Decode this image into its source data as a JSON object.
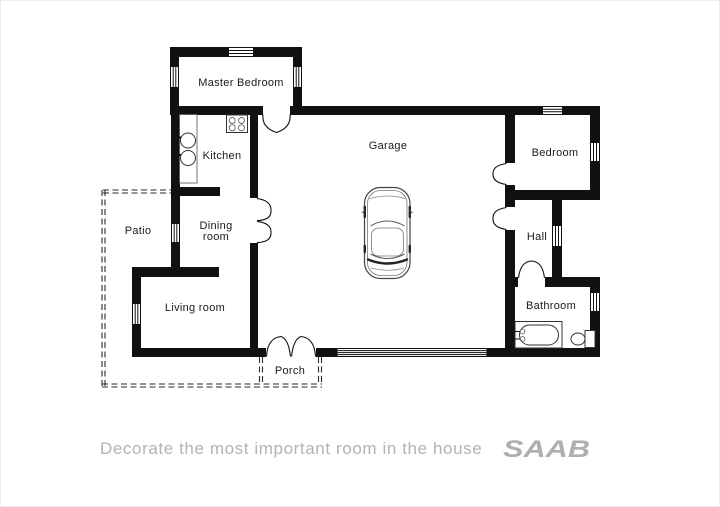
{
  "brand": {
    "tagline": "Decorate the most important room in the house",
    "logo": "SAAB"
  },
  "rooms": {
    "master_bedroom": {
      "label": "Master Bedroom"
    },
    "kitchen": {
      "label": "Kitchen"
    },
    "dining_room": {
      "line1": "Dining",
      "line2": "room"
    },
    "patio": {
      "label": "Patio"
    },
    "living_room": {
      "label": "Living room"
    },
    "porch": {
      "label": "Porch"
    },
    "garage": {
      "label": "Garage"
    },
    "bedroom": {
      "label": "Bedroom"
    },
    "hall": {
      "label": "Hall"
    },
    "bathroom": {
      "label": "Bathroom"
    }
  },
  "fixtures": {
    "car": "car-top-view-icon",
    "bathtub": "bathtub-icon",
    "toilet": "toilet-icon",
    "stove": "stove-icon",
    "sink": "double-sink-icon",
    "garage_door": "garage-door-stripes",
    "patio_outline": "dashed-boundary",
    "porch_outline": "dashed-boundary"
  },
  "colors": {
    "wall": "#111111",
    "label_text": "#1a1a1a",
    "brand_gray": "#b1b1b1"
  }
}
